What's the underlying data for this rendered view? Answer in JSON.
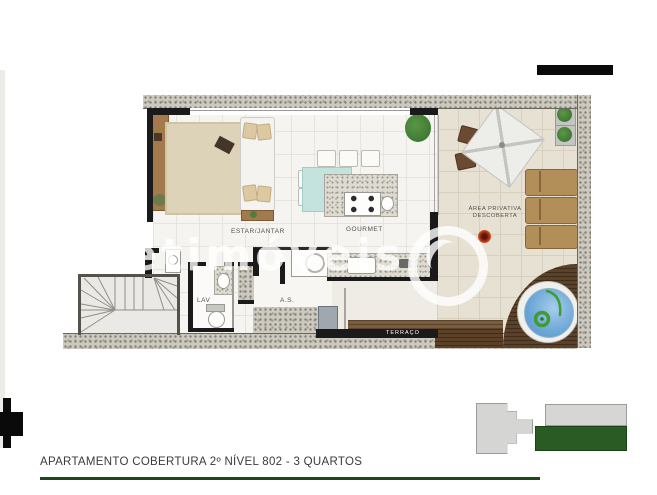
{
  "branding": {
    "logo_bar_color": "#0a0a0a",
    "watermark_text": "netimóveis"
  },
  "floorplan": {
    "rooms": {
      "estar_jantar": "ESTAR/JANTAR",
      "gourmet": "GOURMET",
      "lavabo": "LAV",
      "area_servico": "A.S.",
      "area_privativa_line1": "ÁREA PRIVATIVA",
      "area_privativa_line2": "DESCOBERTA",
      "terraco": "TERRAÇO"
    },
    "colors": {
      "wall_granite": "#ccc9c1",
      "wall_black": "#1a1a1a",
      "floor_tile": "#f5f4f1",
      "terrace_tile": "#e7e1d4",
      "deck_wood": "#5a4128",
      "pool_water": "#6ba6d6",
      "pool_accent": "#3f9c35"
    }
  },
  "site_key": {
    "building_color": "#d5d5d3",
    "highlight_color": "#2a5b24"
  },
  "footer": {
    "caption": "APARTAMENTO COBERTURA 2º NÍVEL 802 - 3 QUARTOS",
    "rule_color": "#1d4a18"
  }
}
